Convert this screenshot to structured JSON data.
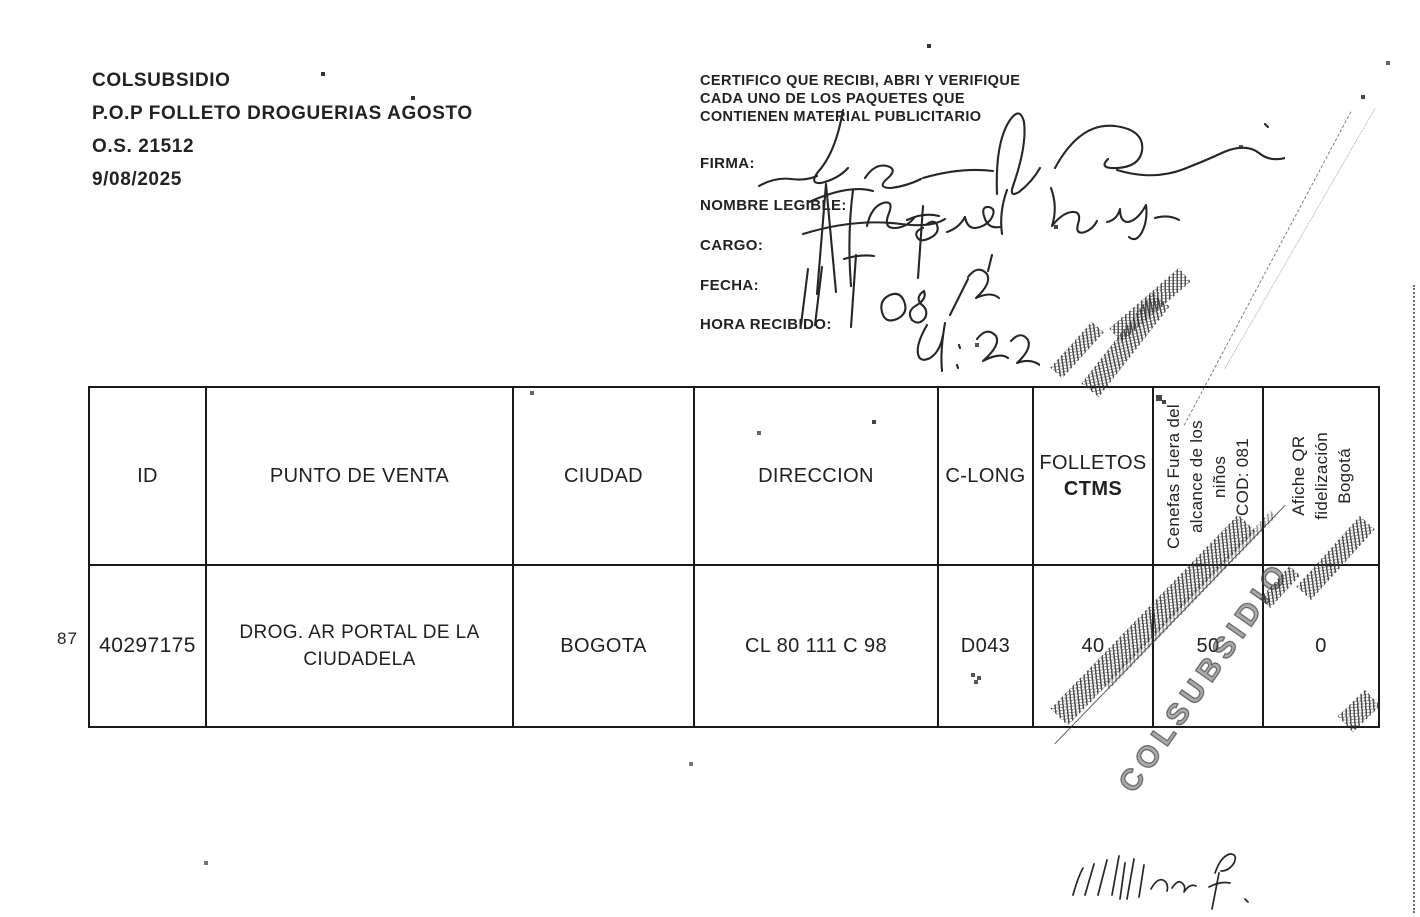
{
  "order_info": {
    "company": "COLSUBSIDIO",
    "campaign": "P.O.P FOLLETO DROGUERIAS AGOSTO",
    "order_number": "O.S. 21512",
    "date": "9/08/2025"
  },
  "certification": {
    "statement": [
      "CERTIFICO QUE RECIBI, ABRI Y VERIFIQUE",
      "CADA  UNO DE LOS PAQUETES QUE",
      "CONTIENEN MATERIAL PUBLICITARIO"
    ],
    "labels": {
      "firma": "FIRMA:",
      "nombre": "NOMBRE LEGIBLE:",
      "cargo": "CARGO:",
      "fecha": "FECHA:",
      "hora": "HORA RECIBIDO:"
    },
    "handwriting": {
      "firma": "firma manuscrita (garabato)",
      "nombre": "Lourdes Aguirre (manuscrito)",
      "cargo": "anotación manuscrita",
      "fecha": "11/08/25 (manuscrito)",
      "hora": "4:22 (manuscrito)"
    }
  },
  "table": {
    "headers": [
      "ID",
      "PUNTO DE VENTA",
      "CIUDAD",
      "DIRECCION",
      "C-LONG"
    ],
    "folletos_header": {
      "line1": "FOLLETOS",
      "line2": "CTMS"
    },
    "rotated_headers": {
      "cenefas": [
        "Cenefas Fuera del",
        "alcance de los",
        "niños",
        "COD: 081"
      ],
      "afiche": [
        "Afiche QR",
        "fidelización",
        "Bogotá"
      ]
    },
    "row": {
      "row_number": "87",
      "id": "40297175",
      "punto_de_venta": "DROG. AR PORTAL DE LA CIUDADELA",
      "ciudad": "BOGOTA",
      "direccion": "CL 80 111 C 98",
      "c_long": "D043",
      "folletos_ctms": "40",
      "cenefas": "50",
      "afiche_qr": "0"
    }
  },
  "annotations": {
    "stamp_text": "COLSUBSIDIO",
    "footer_signature": "William F. (manuscrito)"
  }
}
